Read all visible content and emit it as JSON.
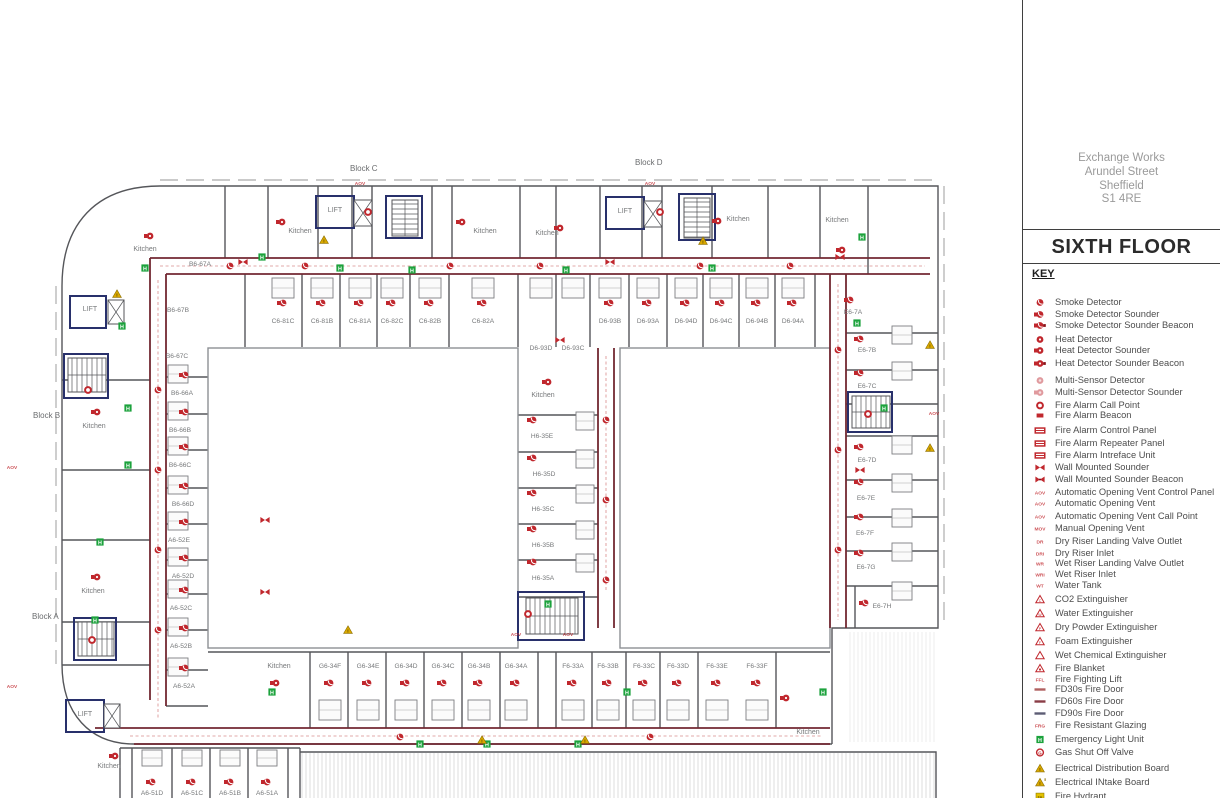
{
  "colors": {
    "red": "#c0272d",
    "maroon": "#722832",
    "navy": "#28306b",
    "green": "#1ca23c",
    "yellow": "#d9a800",
    "wall": "#55565a",
    "pink": "#e09a9e",
    "text_gray": "#76787a"
  },
  "panel": {
    "address": [
      "Exchange Works",
      "Arundel Street",
      "Sheffield",
      "S1 4RE"
    ],
    "floor_title": "SIXTH FLOOR",
    "key_heading": "KEY"
  },
  "legend": [
    {
      "label": "Smoke Detector",
      "icon": "sd"
    },
    {
      "label": "Smoke Detector Sounder",
      "icon": "sds"
    },
    {
      "label": "Smoke Detector Sounder Beacon",
      "icon": "sdsb"
    },
    {
      "label": "Heat Detector",
      "icon": "hd"
    },
    {
      "label": "Heat Detector Sounder",
      "icon": "hds"
    },
    {
      "label": "Heat Detector Sounder Beacon",
      "icon": "hdsb"
    },
    {
      "label": "Multi-Sensor Detector",
      "icon": "ms"
    },
    {
      "label": "Multi-Sensor Detector Sounder",
      "icon": "mss"
    },
    {
      "label": "Fire Alarm Call Point",
      "icon": "cp"
    },
    {
      "label": "Fire Alarm Beacon",
      "icon": "bc"
    },
    {
      "label": "Fire Alarm Control Panel",
      "icon": "pan"
    },
    {
      "label": "Fire Alarm Repeater Panel",
      "icon": "pan"
    },
    {
      "label": "Fire Alarm Intreface Unit",
      "icon": "pan"
    },
    {
      "label": "Wall Mounted Sounder",
      "icon": "bt"
    },
    {
      "label": "Wall Mounted Sounder Beacon",
      "icon": "btb"
    },
    {
      "label": "Automatic Opening Vent Control Panel",
      "icon": "tag",
      "tag": "AOV"
    },
    {
      "label": "Automatic Opening Vent",
      "icon": "tag",
      "tag": "AOV"
    },
    {
      "label": "Automatic Opening Vent Call Point",
      "icon": "tag",
      "tag": "AOV"
    },
    {
      "label": "Manual Opening Vent",
      "icon": "tag",
      "tag": "MOV"
    },
    {
      "label": "Dry Riser Landing Valve Outlet",
      "icon": "tag",
      "tag": "DR"
    },
    {
      "label": "Dry Riser Inlet",
      "icon": "tag",
      "tag": "DRI"
    },
    {
      "label": "Wet Riser Landing Valve Outlet",
      "icon": "tag",
      "tag": "WR"
    },
    {
      "label": "Wet Riser Inlet",
      "icon": "tag",
      "tag": "WRI"
    },
    {
      "label": "Water Tank",
      "icon": "tag",
      "tag": "WT"
    },
    {
      "label": "CO2 Extinguisher",
      "icon": "ext",
      "tag": "C"
    },
    {
      "label": "Water Extinguisher",
      "icon": "ext",
      "tag": "W"
    },
    {
      "label": "Dry Powder Extinguisher",
      "icon": "ext",
      "tag": "P"
    },
    {
      "label": "Foam Extinguisher",
      "icon": "ext",
      "tag": "F"
    },
    {
      "label": "Wet Chemical Extinguisher",
      "icon": "ext",
      "tag": ""
    },
    {
      "label": "Fire Blanket",
      "icon": "blk"
    },
    {
      "label": "Fire Fighting Lift",
      "icon": "tag",
      "tag": "FFL"
    },
    {
      "label": "FD30s Fire Door",
      "icon": "fd30"
    },
    {
      "label": "FD60s Fire Door",
      "icon": "fd60"
    },
    {
      "label": "FD90s Fire Door",
      "icon": "fd90"
    },
    {
      "label": "Fire Resistant Glazing",
      "icon": "tag",
      "tag": "FRG"
    },
    {
      "label": "Emergency Light Unit",
      "icon": "el"
    },
    {
      "label": "Gas Shut Off Valve",
      "icon": "gas"
    },
    {
      "label": "Electrical Distribution Board",
      "icon": "edb"
    },
    {
      "label": "Electrical INtake Board",
      "icon": "eib"
    },
    {
      "label": "Fire Hydrant",
      "icon": "fh"
    }
  ],
  "plan": {
    "kitchen_label": "Kitchen",
    "lift_label": "LIFT",
    "blocks": [
      [
        "Block C",
        350,
        171
      ],
      [
        "Block D",
        635,
        165
      ],
      [
        "Block B",
        33,
        418
      ],
      [
        "Block A",
        32,
        619
      ]
    ],
    "rooms": [
      [
        "B6-67A",
        200,
        266
      ],
      [
        "B6-67B",
        178,
        312
      ],
      [
        "B6-67C",
        177,
        358
      ],
      [
        "B6-66A",
        182,
        395
      ],
      [
        "B6-66B",
        180,
        432
      ],
      [
        "B6-66C",
        180,
        467
      ],
      [
        "B6-66D",
        183,
        506
      ],
      [
        "A6-52E",
        179,
        542
      ],
      [
        "A6-52D",
        183,
        578
      ],
      [
        "A6-52C",
        181,
        610
      ],
      [
        "A6-52B",
        181,
        648
      ],
      [
        "A6-52A",
        184,
        688
      ],
      [
        "C6-81C",
        283,
        323
      ],
      [
        "C6-81B",
        322,
        323
      ],
      [
        "C6-81A",
        360,
        323
      ],
      [
        "C6-82C",
        392,
        323
      ],
      [
        "C6-82B",
        430,
        323
      ],
      [
        "C6-82A",
        483,
        323
      ],
      [
        "D6-93B",
        610,
        323
      ],
      [
        "D6-93A",
        648,
        323
      ],
      [
        "D6-94D",
        686,
        323
      ],
      [
        "D6-94C",
        721,
        323
      ],
      [
        "D6-94B",
        757,
        323
      ],
      [
        "D6-94A",
        793,
        323
      ],
      [
        "D6-93D",
        541,
        350
      ],
      [
        "D6-93C",
        573,
        350
      ],
      [
        "E6-7A",
        853,
        314
      ],
      [
        "E6-7B",
        867,
        352
      ],
      [
        "E6-7C",
        867,
        388
      ],
      [
        "E6-7D",
        867,
        462
      ],
      [
        "E6-7E",
        866,
        500
      ],
      [
        "E6-7F",
        865,
        535
      ],
      [
        "E6-7G",
        866,
        569
      ],
      [
        "E6-7H",
        882,
        608
      ],
      [
        "H6-35E",
        542,
        438
      ],
      [
        "H6-35D",
        544,
        476
      ],
      [
        "H6-35C",
        543,
        511
      ],
      [
        "H6-35B",
        543,
        547
      ],
      [
        "H6-35A",
        543,
        580
      ],
      [
        "G6-34F",
        330,
        668
      ],
      [
        "G6-34E",
        368,
        668
      ],
      [
        "G6-34D",
        406,
        668
      ],
      [
        "G6-34C",
        443,
        668
      ],
      [
        "G6-34B",
        479,
        668
      ],
      [
        "G6-34A",
        516,
        668
      ],
      [
        "F6-33A",
        573,
        668
      ],
      [
        "F6-33B",
        608,
        668
      ],
      [
        "F6-33C",
        644,
        668
      ],
      [
        "F6-33D",
        678,
        668
      ],
      [
        "F6-33E",
        717,
        668
      ],
      [
        "F6-33F",
        757,
        668
      ],
      [
        "A6-51D",
        152,
        795
      ],
      [
        "A6-51C",
        192,
        795
      ],
      [
        "A6-51B",
        230,
        795
      ],
      [
        "A6-51A",
        267,
        795
      ]
    ],
    "kitchens": [
      [
        145,
        251
      ],
      [
        300,
        233
      ],
      [
        485,
        233
      ],
      [
        547,
        235
      ],
      [
        738,
        221
      ],
      [
        837,
        222
      ],
      [
        94,
        428
      ],
      [
        93,
        593
      ],
      [
        543,
        397
      ],
      [
        279,
        668
      ],
      [
        808,
        734
      ],
      [
        109,
        768
      ]
    ],
    "lifts": [
      [
        335,
        212
      ],
      [
        625,
        213
      ],
      [
        90,
        311
      ],
      [
        85,
        716
      ]
    ],
    "markers": [
      [
        "sds",
        283,
        303
      ],
      [
        "sds",
        322,
        303
      ],
      [
        "sds",
        360,
        303
      ],
      [
        "sds",
        392,
        303
      ],
      [
        "sds",
        430,
        303
      ],
      [
        "sds",
        483,
        303
      ],
      [
        "sds",
        610,
        303
      ],
      [
        "sds",
        648,
        303
      ],
      [
        "sds",
        686,
        303
      ],
      [
        "sds",
        721,
        303
      ],
      [
        "sds",
        757,
        303
      ],
      [
        "sds",
        793,
        303
      ],
      [
        "sds",
        850,
        300
      ],
      [
        "sds",
        860,
        339
      ],
      [
        "sds",
        860,
        373
      ],
      [
        "sds",
        860,
        447
      ],
      [
        "sds",
        860,
        482
      ],
      [
        "sds",
        860,
        517
      ],
      [
        "sds",
        860,
        553
      ],
      [
        "sds",
        865,
        603
      ],
      [
        "sds",
        185,
        375
      ],
      [
        "sds",
        185,
        412
      ],
      [
        "sds",
        185,
        447
      ],
      [
        "sds",
        185,
        486
      ],
      [
        "sds",
        185,
        522
      ],
      [
        "sds",
        185,
        558
      ],
      [
        "sds",
        185,
        590
      ],
      [
        "sds",
        185,
        628
      ],
      [
        "sds",
        185,
        668
      ],
      [
        "sds",
        533,
        420
      ],
      [
        "sds",
        533,
        458
      ],
      [
        "sds",
        533,
        493
      ],
      [
        "sds",
        533,
        529
      ],
      [
        "sds",
        533,
        562
      ],
      [
        "sds",
        330,
        683
      ],
      [
        "sds",
        368,
        683
      ],
      [
        "sds",
        406,
        683
      ],
      [
        "sds",
        443,
        683
      ],
      [
        "sds",
        479,
        683
      ],
      [
        "sds",
        516,
        683
      ],
      [
        "sds",
        573,
        683
      ],
      [
        "sds",
        608,
        683
      ],
      [
        "sds",
        644,
        683
      ],
      [
        "sds",
        678,
        683
      ],
      [
        "sds",
        717,
        683
      ],
      [
        "sds",
        757,
        683
      ],
      [
        "sds",
        152,
        782
      ],
      [
        "sds",
        192,
        782
      ],
      [
        "sds",
        230,
        782
      ],
      [
        "sds",
        267,
        782
      ],
      [
        "hd",
        150,
        236
      ],
      [
        "hd",
        282,
        222
      ],
      [
        "hd",
        462,
        222
      ],
      [
        "hd",
        560,
        228
      ],
      [
        "hd",
        718,
        221
      ],
      [
        "hd",
        842,
        250
      ],
      [
        "hd",
        97,
        412
      ],
      [
        "hd",
        97,
        577
      ],
      [
        "hd",
        548,
        382
      ],
      [
        "hd",
        276,
        683
      ],
      [
        "hd",
        786,
        698
      ],
      [
        "hd",
        115,
        756
      ],
      [
        "sd",
        230,
        266
      ],
      [
        "sd",
        305,
        266
      ],
      [
        "sd",
        450,
        266
      ],
      [
        "sd",
        540,
        266
      ],
      [
        "sd",
        700,
        266
      ],
      [
        "sd",
        790,
        266
      ],
      [
        "sd",
        158,
        390
      ],
      [
        "sd",
        158,
        470
      ],
      [
        "sd",
        158,
        550
      ],
      [
        "sd",
        158,
        630
      ],
      [
        "sd",
        838,
        350
      ],
      [
        "sd",
        838,
        450
      ],
      [
        "sd",
        838,
        550
      ],
      [
        "sd",
        400,
        737
      ],
      [
        "sd",
        650,
        737
      ],
      [
        "sd",
        606,
        420
      ],
      [
        "sd",
        606,
        500
      ],
      [
        "sd",
        606,
        580
      ],
      [
        "el",
        145,
        268
      ],
      [
        "el",
        262,
        257
      ],
      [
        "el",
        340,
        268
      ],
      [
        "el",
        412,
        270
      ],
      [
        "el",
        566,
        270
      ],
      [
        "el",
        712,
        268
      ],
      [
        "el",
        862,
        237
      ],
      [
        "el",
        857,
        323
      ],
      [
        "el",
        884,
        408
      ],
      [
        "el",
        122,
        326
      ],
      [
        "el",
        128,
        408
      ],
      [
        "el",
        128,
        465
      ],
      [
        "el",
        100,
        542
      ],
      [
        "el",
        95,
        620
      ],
      [
        "el",
        272,
        692
      ],
      [
        "el",
        420,
        744
      ],
      [
        "el",
        487,
        744
      ],
      [
        "el",
        578,
        744
      ],
      [
        "el",
        627,
        692
      ],
      [
        "el",
        823,
        692
      ],
      [
        "el",
        548,
        604
      ],
      [
        "eb",
        117,
        294
      ],
      [
        "eb",
        324,
        240
      ],
      [
        "eb",
        703,
        241
      ],
      [
        "eb",
        930,
        345
      ],
      [
        "eb",
        930,
        448
      ],
      [
        "eb",
        482,
        740
      ],
      [
        "eb",
        585,
        740
      ],
      [
        "eb",
        348,
        630
      ],
      [
        "cp",
        368,
        212
      ],
      [
        "cp",
        660,
        212
      ],
      [
        "cp",
        88,
        390
      ],
      [
        "cp",
        92,
        640
      ],
      [
        "cp",
        528,
        614
      ],
      [
        "cp",
        868,
        414
      ],
      [
        "bt",
        243,
        262
      ],
      [
        "bt",
        610,
        262
      ],
      [
        "bt",
        840,
        257
      ],
      [
        "bt",
        560,
        340
      ],
      [
        "bt",
        265,
        520
      ],
      [
        "bt",
        265,
        592
      ],
      [
        "bt",
        860,
        470
      ],
      [
        "tag",
        360,
        183
      ],
      [
        "tag",
        650,
        183
      ],
      [
        "tag",
        12,
        467
      ],
      [
        "tag",
        934,
        413
      ],
      [
        "tag",
        516,
        634
      ],
      [
        "tag",
        568,
        634
      ],
      [
        "tag",
        12,
        686
      ]
    ],
    "aov_tag_text": "AOV"
  }
}
